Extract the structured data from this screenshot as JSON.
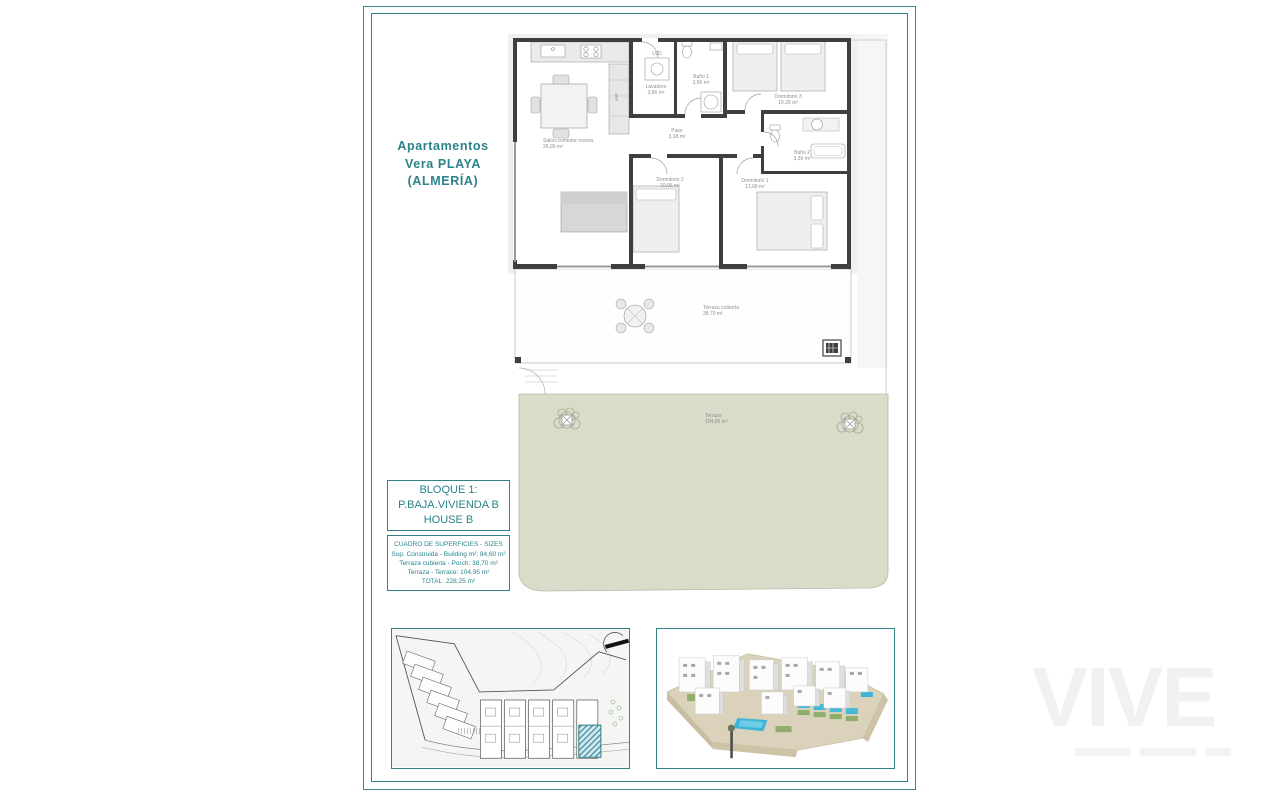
{
  "document": {
    "project_title_lines": [
      "Apartamentos",
      "Vera PLAYA",
      "(ALMERÍA)"
    ],
    "unit_box_lines": [
      "BLOQUE 1:",
      "P.BAJA.VIVIENDA B",
      "HOUSE B"
    ],
    "sizes_table": {
      "title": "CUADRO DE SUPERFICIES - SIZES",
      "rows": [
        "Sup. Construida - Building m²: 84,60 m²",
        "Terraza cubierta - Porch: 38,70 m²",
        "Terraza - Terrace: 104,95 m²",
        "TOTAL: 228,25 m²"
      ]
    },
    "watermark": "VIVE"
  },
  "floor_plan": {
    "rooms": [
      {
        "name": "Salón-comedor-cocina",
        "area": "26,99 m²"
      },
      {
        "name": "Lavadero",
        "area": "3,86 m²"
      },
      {
        "name": "Baño 1",
        "area": "3,90 m²"
      },
      {
        "name": "Dormitorio 3",
        "area": "10,28 m²"
      },
      {
        "name": "Paso",
        "area": "3,18 m²"
      },
      {
        "name": "Baño 2",
        "area": "3,36 m²"
      },
      {
        "name": "Dormitorio 2",
        "area": "10,06 m²"
      },
      {
        "name": "Dormitorio 1",
        "area": "13,68 m²"
      },
      {
        "name": "Terraza cubierta",
        "area": "38,70 m²"
      },
      {
        "name": "Terraza",
        "area": "104,95 m²"
      }
    ],
    "appliances": {
      "washer_dryer": "LVD",
      "water_heater": "HW"
    }
  },
  "colors": {
    "frame_teal": "#35818a",
    "text_teal": "#2a838b",
    "wall_dark": "#3f3f3f",
    "garden_green": "#d9dcc8",
    "hatch_teal": "#4a93a8",
    "pool_blue": "#3db3d8",
    "terrain_beige": "#dbd2bc"
  }
}
